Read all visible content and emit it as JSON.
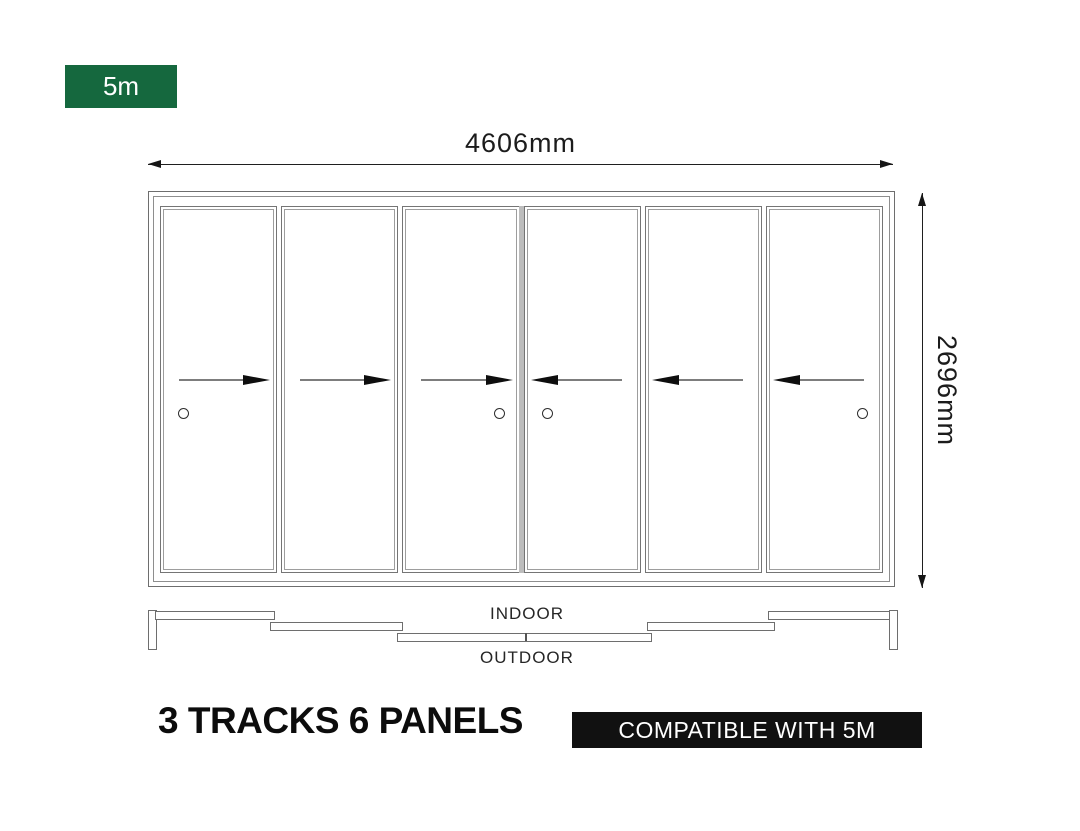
{
  "size_badge": {
    "label": "5m"
  },
  "dimensions": {
    "width_label": "4606mm",
    "height_label": "2696mm"
  },
  "elevation": {
    "tracks_count": "3",
    "panels_count": "6",
    "panels": [
      {
        "arrow": "right",
        "handle": "left"
      },
      {
        "arrow": "right",
        "handle": ""
      },
      {
        "arrow": "right",
        "handle": "right"
      },
      {
        "arrow": "left",
        "handle": "left"
      },
      {
        "arrow": "left",
        "handle": ""
      },
      {
        "arrow": "left",
        "handle": "right"
      }
    ]
  },
  "plan_view": {
    "indoor_label": "INDOOR",
    "outdoor_label": "OUTDOOR"
  },
  "footer": {
    "title": "3 TRACKS 6 PANELS",
    "compat_label": "COMPATIBLE WITH 5M"
  },
  "colors": {
    "green": "#15683E",
    "black": "#111111"
  }
}
